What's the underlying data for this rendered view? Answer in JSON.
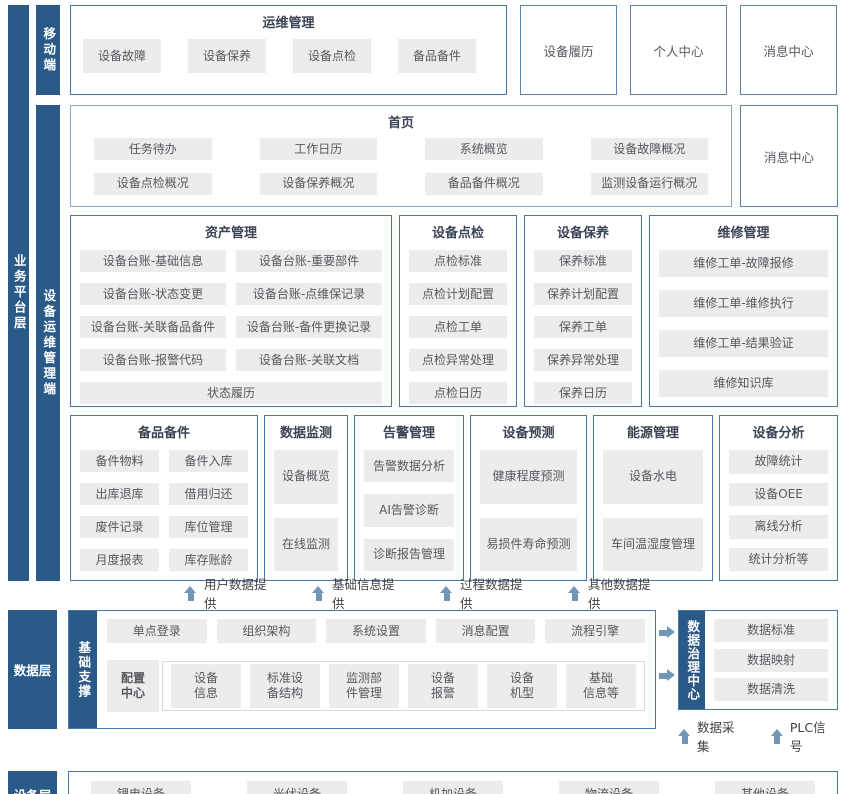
{
  "layers": {
    "business": "业务平台层",
    "data": "数据层",
    "device": "设备层"
  },
  "mobile": {
    "bar": "移动端",
    "ops": {
      "title": "运维管理",
      "items": [
        "设备故障",
        "设备保养",
        "设备点检",
        "备品备件"
      ]
    },
    "standalone": [
      "设备履历",
      "个人中心",
      "消息中心"
    ]
  },
  "terminal": {
    "bar": "设备运维管理端",
    "home": {
      "title": "首页",
      "items": [
        "任务待办",
        "工作日历",
        "系统概览",
        "设备故障概况",
        "设备点检概况",
        "设备保养概况",
        "备品备件概况",
        "监测设备运行概况"
      ]
    },
    "message_center": "消息中心",
    "asset": {
      "title": "资产管理",
      "items": [
        "设备台账-基础信息",
        "设备台账-重要部件",
        "设备台账-状态变更",
        "设备台账-点维保记录",
        "设备台账-关联备品备件",
        "设备台账-备件更换记录",
        "设备台账-报警代码",
        "设备台账-关联文档",
        "状态履历"
      ]
    },
    "inspection": {
      "title": "设备点检",
      "items": [
        "点检标准",
        "点检计划配置",
        "点检工单",
        "点检异常处理",
        "点检日历"
      ]
    },
    "maintenance": {
      "title": "设备保养",
      "items": [
        "保养标准",
        "保养计划配置",
        "保养工单",
        "保养异常处理",
        "保养日历"
      ]
    },
    "repair": {
      "title": "维修管理",
      "items": [
        "维修工单-故障报修",
        "维修工单-维修执行",
        "维修工单-结果验证",
        "维修知识库"
      ]
    },
    "spares": {
      "title": "备品备件",
      "items": [
        "备件物料",
        "备件入库",
        "出库退库",
        "借用归还",
        "废件记录",
        "库位管理",
        "月度报表",
        "库存账龄"
      ]
    },
    "monitor": {
      "title": "数据监测",
      "items": [
        "设备概览",
        "在线监测"
      ]
    },
    "alarm": {
      "title": "告警管理",
      "items": [
        "告警数据分析",
        "AI告警诊断",
        "诊断报告管理"
      ]
    },
    "predict": {
      "title": "设备预测",
      "items": [
        "健康程度预测",
        "易损件寿命预测"
      ]
    },
    "energy": {
      "title": "能源管理",
      "items": [
        "设备水电",
        "车间温湿度管理"
      ]
    },
    "analysis": {
      "title": "设备分析",
      "items": [
        "故障统计",
        "设备OEE",
        "离线分析",
        "统计分析等"
      ]
    },
    "feeds": [
      "用户数据提供",
      "基础信息提供",
      "过程数据提供",
      "其他数据提供"
    ]
  },
  "data_layer": {
    "bar": "数据层",
    "support_bar": "基础支撑",
    "base_items": [
      "单点登录",
      "组织架构",
      "系统设置",
      "消息配置",
      "流程引擎"
    ],
    "config_center": "配置\n中心",
    "config_items": [
      "设备\n信息",
      "标准设\n备结构",
      "监测部\n件管理",
      "设备\n报警",
      "设备\n机型",
      "基础\n信息等"
    ],
    "governance": {
      "bar": "数据治理中心",
      "items": [
        "数据标准",
        "数据映射",
        "数据清洗"
      ]
    },
    "inflows": [
      "数据采集",
      "PLC信号"
    ]
  },
  "device_layer": {
    "bar": "设备层",
    "items": [
      "锂电设备",
      "光伏设备",
      "机加设备",
      "物流设备",
      "其他设备"
    ]
  },
  "colors": {
    "accent_dark_blue": "#2a5a88",
    "box_border": "#4b79a6",
    "chip_bg": "#ececec",
    "arrow_blue": "#7096b8"
  }
}
